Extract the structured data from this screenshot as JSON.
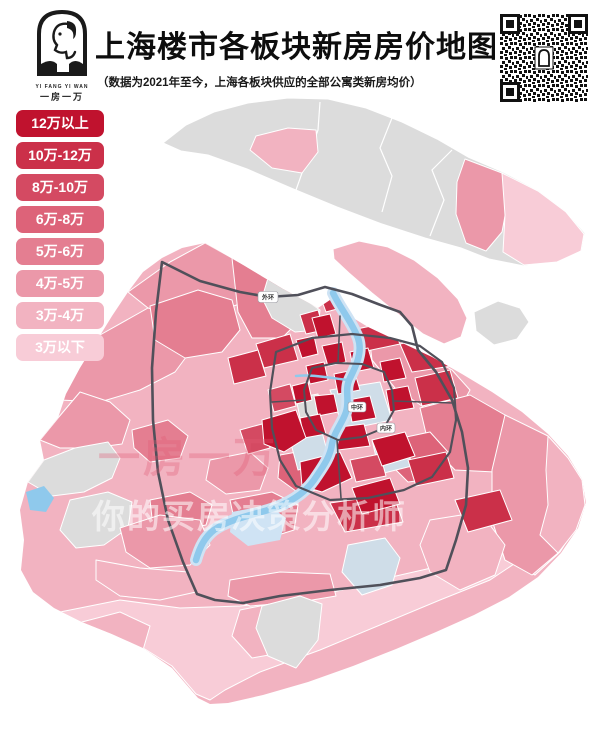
{
  "header": {
    "title": "上海楼市各板块新房房价地图",
    "subtitle": "（数据为2021年至今，上海各板块供应的全部公寓类新房均价）",
    "logo": {
      "line1": "YI FANG YI WAN",
      "line2": "一房一万"
    }
  },
  "legend": {
    "items": [
      {
        "label": "12万以上",
        "color": "#c0122e"
      },
      {
        "label": "10万-12万",
        "color": "#cb3049"
      },
      {
        "label": "8万-10万",
        "color": "#d44a62"
      },
      {
        "label": "6万-8万",
        "color": "#dd6379"
      },
      {
        "label": "5万-6万",
        "color": "#e47e91"
      },
      {
        "label": "4万-5万",
        "color": "#eb98a9"
      },
      {
        "label": "3万-4万",
        "color": "#f2b3c1"
      },
      {
        "label": "3万以下",
        "color": "#f8ccd7"
      }
    ]
  },
  "map": {
    "road_labels": [
      {
        "text": "外环"
      },
      {
        "text": "中环"
      },
      {
        "text": "内环"
      }
    ],
    "watermark_primary": "一房一万",
    "watermark_secondary": "你的买房决策分析师"
  },
  "colors": {
    "band1": "#c0122e",
    "band2": "#cb3049",
    "band3": "#d44a62",
    "band4": "#dd6379",
    "band5": "#e47e91",
    "band6": "#eb98a9",
    "band7": "#f2b3c1",
    "band8": "#f8ccd7",
    "nodata": "#dcdcdc",
    "bluegray": "#cfdde8",
    "water": "#8fc9ec",
    "waterlight": "#cfe3f4",
    "road": "#50505a",
    "wmred": "#e25a74"
  }
}
